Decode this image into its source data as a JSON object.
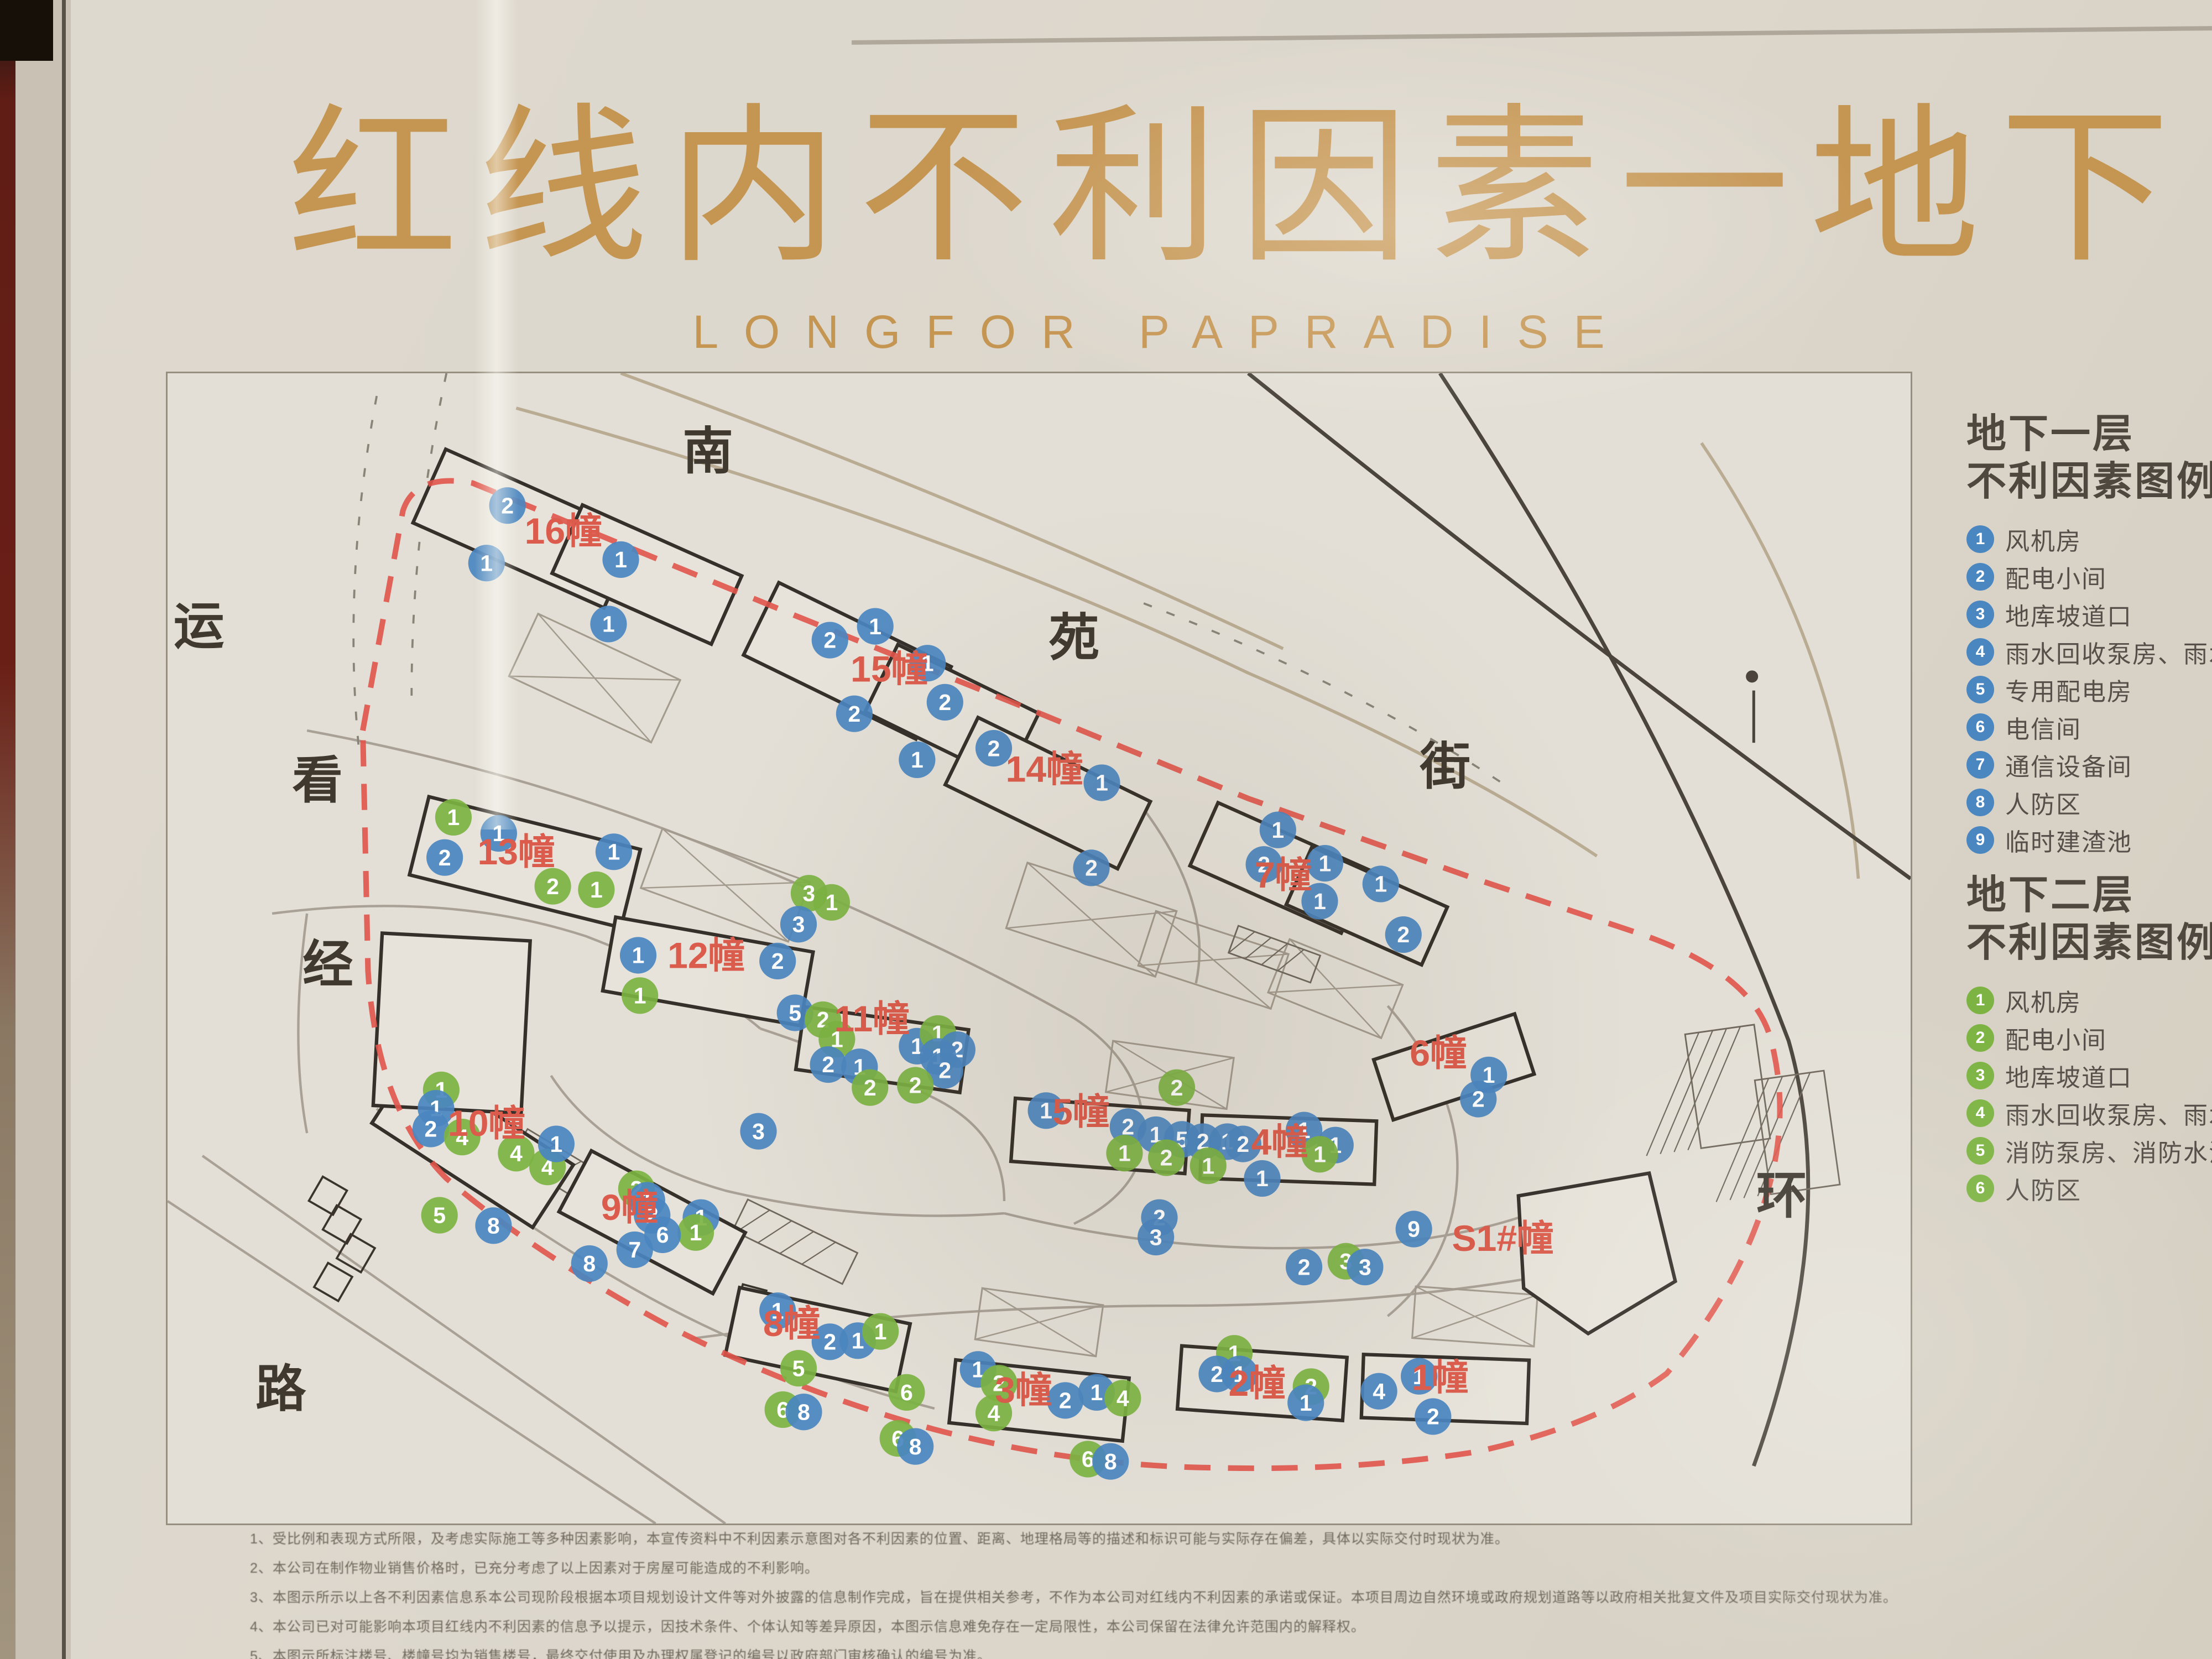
{
  "colors": {
    "gold": "#c59552",
    "red_label": "#db5c4c",
    "red_line": "#e0544a",
    "blue": "#4a86c0",
    "green": "#7cb342",
    "ink": "#3a342c",
    "street": "#3f3930"
  },
  "title": {
    "cn": "红线内不利因素一地下",
    "en": "LONGFOR  PAPRADISE"
  },
  "legend_b1": {
    "title_line1": "地下一层",
    "title_line2": "不利因素图例",
    "color": "#4a86c0",
    "items": [
      "风机房",
      "配电小间",
      "地库坡道口",
      "雨水回收泵房、雨水回收池",
      "专用配电房",
      "电信间",
      "通信设备间",
      "人防区",
      "临时建渣池"
    ]
  },
  "legend_b2": {
    "title_line1": "地下二层",
    "title_line2": "不利因素图例",
    "color": "#7cb342",
    "items": [
      "风机房",
      "配电小间",
      "地库坡道口",
      "雨水回收泵房、雨水回收池",
      "消防泵房、消防水池",
      "人防区"
    ]
  },
  "map": {
    "streets": [
      {
        "t": "运",
        "x": 1.8,
        "y": 23.5
      },
      {
        "t": "看",
        "x": 8.6,
        "y": 36.9
      },
      {
        "t": "经",
        "x": 9.2,
        "y": 52.9
      },
      {
        "t": "路",
        "x": 6.5,
        "y": 89.8
      },
      {
        "t": "南",
        "x": 31.0,
        "y": 8.3
      },
      {
        "t": "苑",
        "x": 52.0,
        "y": 24.5
      },
      {
        "t": "街",
        "x": 73.3,
        "y": 35.7
      },
      {
        "t": "环",
        "x": 92.6,
        "y": 73.0
      }
    ],
    "buildings": [
      {
        "label": "16幢",
        "x": 22.7,
        "y": 14.8
      },
      {
        "label": "15幢",
        "x": 41.4,
        "y": 26.8
      },
      {
        "label": "14幢",
        "x": 50.3,
        "y": 35.5
      },
      {
        "label": "13幢",
        "x": 20.0,
        "y": 42.7
      },
      {
        "label": "12幢",
        "x": 30.9,
        "y": 51.7
      },
      {
        "label": "11幢",
        "x": 40.4,
        "y": 57.2
      },
      {
        "label": "10幢",
        "x": 18.3,
        "y": 66.3
      },
      {
        "label": "9幢",
        "x": 26.5,
        "y": 73.6
      },
      {
        "label": "8幢",
        "x": 35.8,
        "y": 83.7
      },
      {
        "label": "3幢",
        "x": 49.1,
        "y": 89.5
      },
      {
        "label": "2幢",
        "x": 62.5,
        "y": 88.9
      },
      {
        "label": "1幢",
        "x": 73.0,
        "y": 88.4
      },
      {
        "label": "5幢",
        "x": 52.4,
        "y": 65.3
      },
      {
        "label": "4幢",
        "x": 63.8,
        "y": 67.9
      },
      {
        "label": "7幢",
        "x": 64.0,
        "y": 44.7
      },
      {
        "label": "6幢",
        "x": 72.9,
        "y": 60.2
      },
      {
        "label": "S1#幢",
        "x": 76.6,
        "y": 76.3
      }
    ],
    "markers": [
      [
        19.5,
        11.5,
        "b",
        2
      ],
      [
        18.3,
        16.5,
        "b",
        1
      ],
      [
        26,
        16.2,
        "b",
        1
      ],
      [
        25.3,
        21.8,
        "b",
        1
      ],
      [
        38,
        23.2,
        "b",
        2
      ],
      [
        40.6,
        22,
        "b",
        1
      ],
      [
        43.6,
        25.2,
        "b",
        1
      ],
      [
        39.4,
        29.6,
        "b",
        2
      ],
      [
        44.6,
        28.6,
        "b",
        2
      ],
      [
        43,
        33.6,
        "b",
        1
      ],
      [
        47.4,
        32.6,
        "b",
        2
      ],
      [
        53.6,
        35.6,
        "b",
        1
      ],
      [
        53,
        43,
        "b",
        2
      ],
      [
        16.4,
        38.6,
        "g",
        1
      ],
      [
        19,
        40,
        "b",
        1
      ],
      [
        15.9,
        42.1,
        "b",
        2
      ],
      [
        22.1,
        44.6,
        "g",
        2
      ],
      [
        24.6,
        44.9,
        "g",
        1
      ],
      [
        25.6,
        41.6,
        "b",
        1
      ],
      [
        36.8,
        45.2,
        "g",
        3
      ],
      [
        38.1,
        46,
        "g",
        1
      ],
      [
        36.2,
        47.9,
        "b",
        3
      ],
      [
        27,
        50.6,
        "b",
        1
      ],
      [
        27.1,
        54.1,
        "g",
        1
      ],
      [
        35,
        51.1,
        "b",
        2
      ],
      [
        36,
        55.6,
        "b",
        5
      ],
      [
        37.6,
        56.2,
        "g",
        2
      ],
      [
        38.4,
        57.9,
        "g",
        1
      ],
      [
        43,
        58.5,
        "b",
        1
      ],
      [
        44.2,
        57.4,
        "g",
        1
      ],
      [
        45.3,
        58.8,
        "b",
        2
      ],
      [
        44.2,
        59.4,
        "b",
        1
      ],
      [
        44.6,
        60.6,
        "b",
        2
      ],
      [
        37.9,
        60.1,
        "b",
        2
      ],
      [
        39.7,
        60.3,
        "b",
        1
      ],
      [
        40.3,
        62.1,
        "g",
        2
      ],
      [
        42.9,
        61.9,
        "g",
        2
      ],
      [
        33.9,
        65.9,
        "b",
        3
      ],
      [
        15.7,
        62.3,
        "g",
        1
      ],
      [
        15.4,
        63.9,
        "b",
        1
      ],
      [
        15.1,
        65.7,
        "b",
        2
      ],
      [
        16.9,
        66.4,
        "g",
        4
      ],
      [
        20,
        67.8,
        "g",
        4
      ],
      [
        21.8,
        69,
        "g",
        4
      ],
      [
        22.3,
        67,
        "b",
        1
      ],
      [
        15.6,
        73.2,
        "g",
        5
      ],
      [
        18.7,
        74.1,
        "b",
        8
      ],
      [
        26.9,
        70.9,
        "g",
        2
      ],
      [
        27.5,
        71.9,
        "b",
        1
      ],
      [
        27.8,
        73.2,
        "b",
        2
      ],
      [
        30.6,
        73.4,
        "b",
        1
      ],
      [
        30.3,
        74.7,
        "g",
        1
      ],
      [
        28.4,
        74.9,
        "b",
        6
      ],
      [
        26.8,
        76.2,
        "b",
        7
      ],
      [
        24.2,
        77.4,
        "b",
        8
      ],
      [
        35,
        81.5,
        "b",
        1
      ],
      [
        38,
        84.2,
        "b",
        2
      ],
      [
        39.6,
        84.1,
        "b",
        1
      ],
      [
        40.9,
        83.3,
        "g",
        1
      ],
      [
        36.2,
        86.5,
        "g",
        5
      ],
      [
        35.3,
        90.1,
        "g",
        6
      ],
      [
        36.5,
        90.3,
        "b",
        8
      ],
      [
        42.4,
        88.6,
        "g",
        6
      ],
      [
        41.9,
        92.6,
        "g",
        6
      ],
      [
        42.9,
        93.3,
        "b",
        8
      ],
      [
        46.5,
        86.6,
        "b",
        1
      ],
      [
        47.7,
        87.8,
        "g",
        2
      ],
      [
        51.5,
        89.3,
        "b",
        2
      ],
      [
        53.3,
        88.6,
        "b",
        1
      ],
      [
        54.8,
        89.1,
        "g",
        4
      ],
      [
        47.4,
        90.4,
        "g",
        4
      ],
      [
        52.8,
        94.4,
        "g",
        6
      ],
      [
        54.1,
        94.6,
        "b",
        8
      ],
      [
        61.2,
        85.2,
        "g",
        1
      ],
      [
        60.2,
        87,
        "b",
        2
      ],
      [
        61.5,
        87,
        "b",
        1
      ],
      [
        65.6,
        88.1,
        "g",
        2
      ],
      [
        65.3,
        89.5,
        "b",
        1
      ],
      [
        69.5,
        88.5,
        "b",
        4
      ],
      [
        71.8,
        87.2,
        "b",
        1
      ],
      [
        72.6,
        90.7,
        "b",
        2
      ],
      [
        50.4,
        64.1,
        "b",
        1
      ],
      [
        55.1,
        65.5,
        "b",
        2
      ],
      [
        56.7,
        66.2,
        "b",
        1
      ],
      [
        58.2,
        66.6,
        "b",
        5
      ],
      [
        59.4,
        66.8,
        "b",
        2
      ],
      [
        60.8,
        66.8,
        "b",
        1
      ],
      [
        61.7,
        67,
        "b",
        2
      ],
      [
        54.9,
        67.8,
        "g",
        1
      ],
      [
        57.3,
        68.2,
        "g",
        2
      ],
      [
        59.7,
        68.9,
        "g",
        1
      ],
      [
        57.9,
        62.1,
        "g",
        2
      ],
      [
        65.2,
        65.8,
        "b",
        1
      ],
      [
        67,
        67.1,
        "b",
        1
      ],
      [
        66.1,
        67.9,
        "g",
        1
      ],
      [
        62.8,
        70,
        "b",
        1
      ],
      [
        56.9,
        73.4,
        "b",
        2
      ],
      [
        56.7,
        75.1,
        "b",
        3
      ],
      [
        65.2,
        77.7,
        "b",
        2
      ],
      [
        67.6,
        77.2,
        "g",
        3
      ],
      [
        68.7,
        77.7,
        "b",
        3
      ],
      [
        71.5,
        74.4,
        "b",
        9
      ],
      [
        63.7,
        39.7,
        "b",
        1
      ],
      [
        62.9,
        42.7,
        "b",
        2
      ],
      [
        66.4,
        42.6,
        "b",
        1
      ],
      [
        66.1,
        45.9,
        "b",
        1
      ],
      [
        69.6,
        44.4,
        "b",
        1
      ],
      [
        70.9,
        48.8,
        "b",
        2
      ],
      [
        75.8,
        61,
        "b",
        1
      ],
      [
        75.2,
        63.1,
        "b",
        2
      ]
    ],
    "footprints": [
      [
        20.5,
        13.5,
        12,
        7,
        24
      ],
      [
        27.5,
        17.5,
        10,
        6.5,
        24
      ],
      [
        39,
        25,
        11,
        7,
        26
      ],
      [
        45,
        29.5,
        9,
        6.5,
        26
      ],
      [
        50.5,
        36.5,
        11,
        6.5,
        26
      ],
      [
        20.5,
        42.5,
        12.5,
        7,
        14
      ],
      [
        31,
        52,
        11.5,
        6.5,
        10
      ],
      [
        41,
        58.8,
        9.5,
        5.5,
        8
      ],
      [
        17.5,
        67,
        11,
        6.5,
        33
      ],
      [
        27.8,
        73.8,
        10,
        6,
        28
      ],
      [
        37.3,
        84,
        10,
        6,
        12
      ],
      [
        50,
        89.3,
        10,
        5.5,
        6
      ],
      [
        62.8,
        87.8,
        9.5,
        5.5,
        4
      ],
      [
        73.3,
        88.3,
        9.5,
        5.5,
        2
      ],
      [
        53.5,
        66.3,
        10,
        5.5,
        4
      ],
      [
        64.3,
        67.5,
        10,
        5.5,
        2
      ],
      [
        73.8,
        60.3,
        8.5,
        5.5,
        -18
      ],
      [
        63.8,
        43,
        9.5,
        6,
        24
      ],
      [
        68.8,
        46.3,
        8.5,
        5.5,
        24
      ],
      [
        16.3,
        56.5,
        8.5,
        15,
        3
      ]
    ],
    "s1_poly": "M 77.5,47.2 L 85,45.9 L 86.5,52.1 L 81.5,55.1 L 77.8,52.5 Z",
    "crosses": [
      [
        24.5,
        26.5,
        9,
        6,
        25
      ],
      [
        32,
        44.5,
        9,
        5.5,
        20
      ],
      [
        53,
        47.5,
        9,
        6,
        18
      ],
      [
        60,
        51,
        8,
        5,
        18
      ],
      [
        67,
        53.5,
        7,
        5,
        22
      ],
      [
        57.5,
        61,
        7,
        4.5,
        8
      ],
      [
        50,
        82.5,
        7,
        4.5,
        8
      ],
      [
        75,
        82,
        7,
        4.5,
        4
      ]
    ],
    "hatches": [
      [
        24,
        70.5,
        9,
        3,
        31
      ],
      [
        36,
        75.5,
        7,
        3,
        26
      ],
      [
        89.5,
        62,
        4,
        10,
        -8
      ],
      [
        93.5,
        66,
        4,
        10,
        -8
      ],
      [
        63.5,
        50.5,
        5,
        2.5,
        20
      ]
    ],
    "squares": [
      [
        9.2,
        71.5,
        1.6,
        30
      ],
      [
        10,
        74,
        1.6,
        30
      ],
      [
        10.8,
        76.5,
        1.6,
        30
      ],
      [
        9.5,
        79,
        1.6,
        30
      ],
      [
        33.5,
        80.5,
        1.4,
        15
      ],
      [
        35,
        82,
        1.4,
        15
      ]
    ],
    "redline": "M 11.2,20.5 L 13.5,7.9 Q 14.2,5.7 17.5,6.3 L 36,13.9 L 50,19.5 L 62,24.4 L 75,29 L 84,32 Q 91,34.3 92,38.3 Q 93,42.2 92,46.2 Q 90.5,52.1 86,57.4 Q 82,60.4 75,61.9 Q 68,63 60,62.8 Q 52,62.7 44,60.6 Q 36,58.4 29,54.8 Q 21,50.5 16,46.2 Q 12,42.2 11.5,34.3 Z",
    "roads_dark": [
      "M 62,0 Q 80,14.5 100,29",
      "M 73,0 Q 86,19.8 93,38.3 Q 96,48.8 91,62.7"
    ],
    "roads_tan": [
      "M 20,2 Q 44,8.6 62,17.2 Q 74,22.4 82,27.7",
      "M 26,0 Q 46,7.3 64,15.8",
      "M 88,4 Q 96,15.8 97,29"
    ],
    "roads_light": [
      "M 8,20.5 Q 22,23.1 34,28.4 Q 45,33 52,37",
      "M 6,31 Q 16,29.7 24,32.3 Q 31,35 34,37.6",
      "M 22,40.3 Q 25,44.9 32,46.9 Q 40,48.8 48,48.2",
      "M 34,37.6 Q 40,39.6 44,41.6 Q 48,43.6 48,47.5",
      "M 48,48.2 Q 56,50.2 64,50.2 Q 74,50.2 80,47.5",
      "M 52,37 Q 56,39.6 56,43.6 Q 56,46.9 52,48.8",
      "M 56,25 Q 60,30.4 59,35",
      "M 70,36.3 Q 74,40.9 74,45.5 Q 74,50.8 70,54.1",
      "M 8,31 Q 7,38.3 8,43.6",
      "M 30,55.4 Q 44,53.5 58,53.5 Q 72,53.5 84,50.8",
      "M 12,42.2 Q 18,47.5 26,52.1 Q 34,56.8 44,59.4",
      "M 0,47.5 L 28,66",
      "M 2,44.9 L 32,66"
    ],
    "roads_dotted": [
      "M 12,1.3 Q 10,11.9 11,21.8",
      "M 16,0 Q 14,9.2 14,18.5",
      "M 56,13.2 Q 68,17.8 77,23.8"
    ]
  },
  "notes": [
    "1、受比例和表现方式所限，及考虑实际施工等多种因素影响，本宣传资料中不利因素示意图对各不利因素的位置、距离、地理格局等的描述和标识可能与实际存在偏差，具体以实际交付时现状为准。",
    "2、本公司在制作物业销售价格时，已充分考虑了以上因素对于房屋可能造成的不利影响。",
    "3、本图示所示以上各不利因素信息系本公司现阶段根据本项目规划设计文件等对外披露的信息制作完成，旨在提供相关参考，不作为本公司对红线内不利因素的承诺或保证。本项目周边自然环境或政府规划道路等以政府相关批复文件及项目实际交付现状为准。",
    "4、本公司已对可能影响本项目红线内不利因素的信息予以提示，因技术条件、个体认知等差异原因，本图示信息难免存在一定局限性，本公司保留在法律允许范围内的解释权。",
    "5、本图示所标注楼号、楼幢号均为销售楼号，最终交付使用及办理权属登记的编号以政府部门审核确认的编号为准。",
    "上述内容系本公司根据2021年3月的现状资料制作，未来不排除区域内有关内容发生变更的可能，本示意图仅供参考，如有内容变更恕不另行通知，亦不承担任何责任。"
  ]
}
